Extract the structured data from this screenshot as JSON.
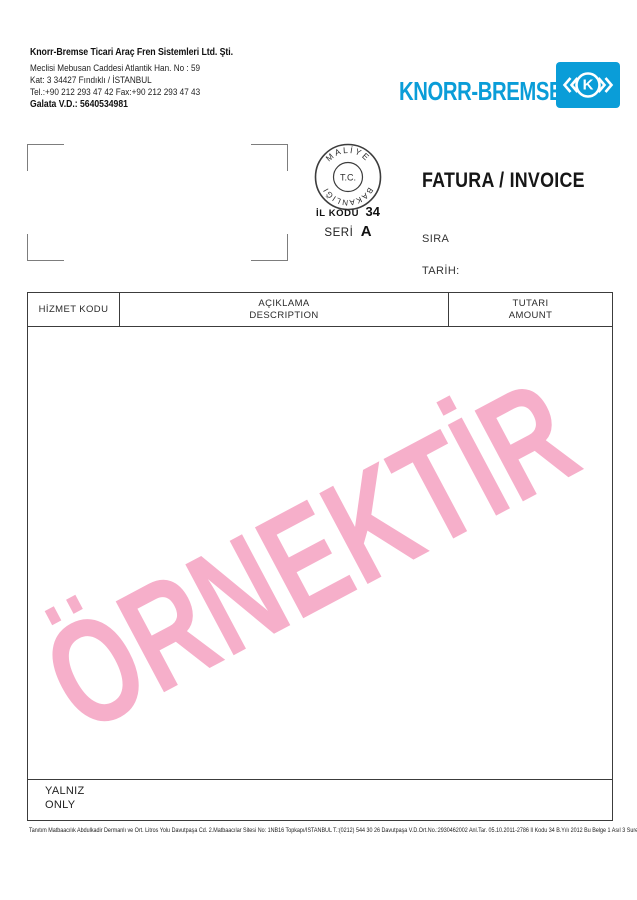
{
  "colors": {
    "brand_blue": "#0A9DD8",
    "watermark_pink": "#F6AFCA",
    "line_dark": "#3C3C3C"
  },
  "header": {
    "company_name": "Knorr-Bremse Ticari Araç Fren Sistemleri Ltd. Şti.",
    "address_line1": "Meclisi Mebusan Caddesi Atlantik Han. No : 59",
    "address_line2": "Kat: 3 34427 Fındıklı / İSTANBUL",
    "phone_line": "Tel.:+90 212 293 47 42 Fax:+90 212 293 47 43",
    "tax_line": "Galata V.D.: 5640534981"
  },
  "logo": {
    "wordmark": "KNORR-BREMSE",
    "emblem_letter": "K"
  },
  "stamp": {
    "top_text": "MALİYE",
    "center_text": "T.C.",
    "bottom_text": "BAKANLIĞI",
    "il_kodu_label": "İL KODU",
    "il_kodu_value": "34",
    "seri_label": "SERİ",
    "seri_value": "A"
  },
  "invoice": {
    "title": "FATURA / INVOICE",
    "sira_label": "SIRA",
    "tarih_label": "TARİH:"
  },
  "table": {
    "columns": [
      {
        "line1": "HİZMET KODU",
        "line2": ""
      },
      {
        "line1": "AÇIKLAMA",
        "line2": "DESCRIPTION"
      },
      {
        "line1": "TUTARI",
        "line2": "AMOUNT"
      }
    ],
    "footer": {
      "line1": "YALNIZ",
      "line2": "ONLY"
    }
  },
  "watermark": {
    "text": "ÖRNEKTİR"
  },
  "fine_print": "Tanıtım Matbaacılık Abdulkadir Dermanlı ve Ort. Litros Yolu Davutpaşa Cd. 2.Matbaacılar Sitesi No: 1NB16 Topkapı/İSTANBUL  T.:(0212) 544 30 26 Davutpaşa V.D.Ort.No.:2930462002 Anl.Tar. 05.10.2011-2786 İl Kodu 34 B.Yılı 2012 Bu Belge 1 Asıl 3 Surettir."
}
